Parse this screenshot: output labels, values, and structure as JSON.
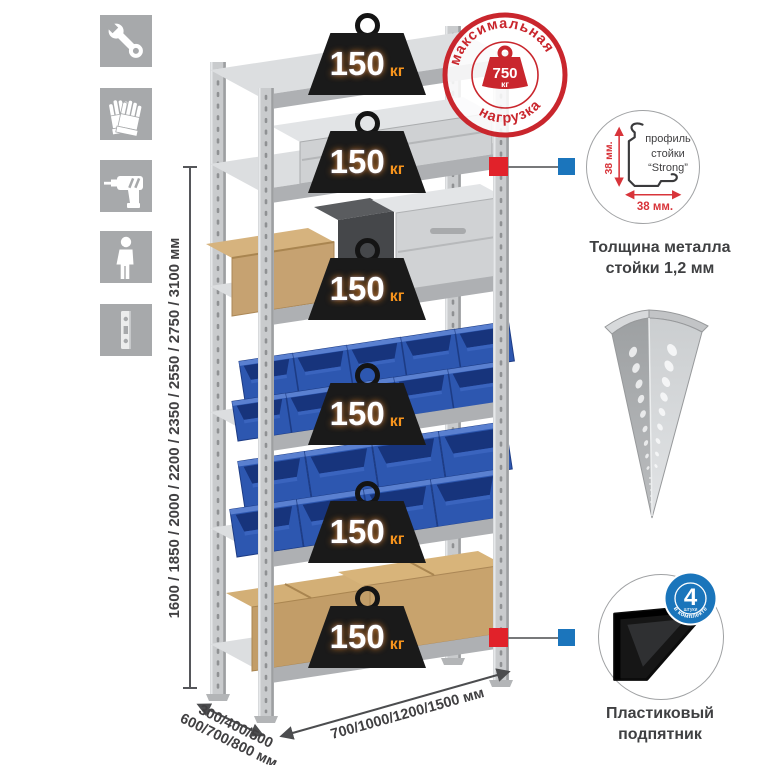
{
  "colors": {
    "stamp-red": "#c9262d",
    "marker-red": "#e1222a",
    "marker-blue": "#1b75bc",
    "badge-blue": "#1a75bb",
    "weight-black": "#1a1a1a",
    "weight-unit-orange": "#f7941d",
    "bin-blue": "#2d57b0",
    "dim-text": "#414042"
  },
  "left_icons": [
    {
      "name": "wrench"
    },
    {
      "name": "gloves"
    },
    {
      "name": "drill"
    },
    {
      "name": "person"
    },
    {
      "name": "rack-post-profile"
    }
  ],
  "height_dimension": {
    "label": "1600 / 1850 / 2000 / 2200 / 2350 / 2550 / 2750 / 3100 мм",
    "values_mm": [
      1600,
      1850,
      2000,
      2200,
      2350,
      2550,
      2750,
      3100
    ]
  },
  "depth_dimension": {
    "line1": "300/400/500",
    "line2": "600/700/800 мм",
    "values_mm": [
      300,
      400,
      500,
      600,
      700,
      800
    ]
  },
  "width_dimension": {
    "label": "700/1000/1200/1500 мм",
    "values_mm": [
      700,
      1000,
      1200,
      1500
    ]
  },
  "shelf_weights": [
    {
      "value": "150",
      "unit": "кг"
    },
    {
      "value": "150",
      "unit": "кг"
    },
    {
      "value": "150",
      "unit": "кг"
    },
    {
      "value": "150",
      "unit": "кг"
    },
    {
      "value": "150",
      "unit": "кг"
    },
    {
      "value": "150",
      "unit": "кг"
    }
  ],
  "max_load_stamp": {
    "arc_top": "максимальная",
    "arc_bottom": "нагрузка",
    "value": "750",
    "unit": "кг"
  },
  "profile_detail": {
    "label_line1": "профиль",
    "label_line2": "стойки",
    "label_line3": "“Strong”",
    "height_dim": "38 мм.",
    "width_dim": "38 мм.",
    "caption_line1": "Толщина металла",
    "caption_line2": "стойки 1,2 мм"
  },
  "foot_detail": {
    "badge_value": "4",
    "badge_unit": "штуки",
    "badge_arc": "в комплекте",
    "caption_line1": "Пластиковый",
    "caption_line2": "подпятник"
  }
}
